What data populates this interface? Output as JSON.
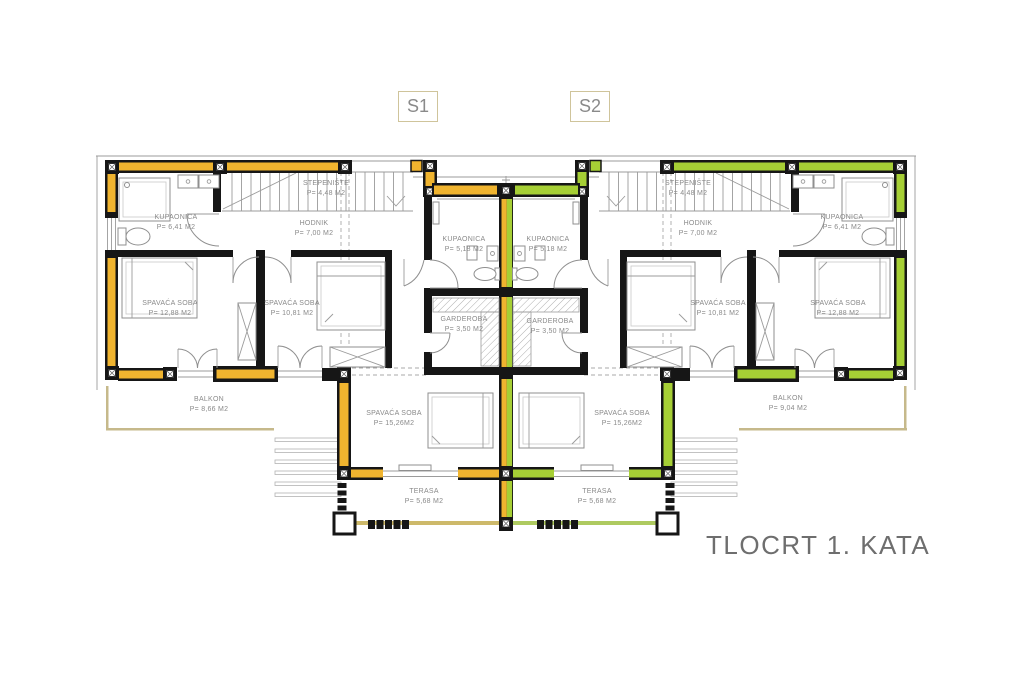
{
  "title": "TLOCRT 1. KATA",
  "section_labels": {
    "s1": "S1",
    "s2": "S2"
  },
  "colors": {
    "s1_wall": "#F0B42F",
    "s2_wall": "#A6CF35",
    "balcony_line": "#C6B98B",
    "terrace_s1_line": "#CDB96A",
    "terrace_s2_line": "#AECA60",
    "box_border": "#CFC49B",
    "label_text": "#8a8a8a",
    "title_text": "#6e6e6e"
  },
  "rooms": {
    "s1": {
      "stepeniste": {
        "name": "STEPENIŠTE",
        "area": "P= 4,48 M2"
      },
      "kupaonica": {
        "name": "KUPAONICA",
        "area": "P= 6,41 M2"
      },
      "hodnik": {
        "name": "HODNIK",
        "area": "P= 7,00 M2"
      },
      "spavaca_velika": {
        "name": "SPAVAĆA SOBA",
        "area": "P= 12,88 M2"
      },
      "spavaca_srednja": {
        "name": "SPAVAĆA SOBA",
        "area": "P= 10,81 M2"
      },
      "kupaonica_mala": {
        "name": "KUPAONICA",
        "area": "P= 5,18 M2"
      },
      "garderoba": {
        "name": "GARDEROBA",
        "area": "P= 3,50 M2"
      },
      "spavaca_donja": {
        "name": "SPAVAĆA SOBA",
        "area": "P= 15,26M2"
      },
      "balkon": {
        "name": "BALKON",
        "area": "P= 8,66 M2"
      },
      "terasa": {
        "name": "TERASA",
        "area": "P= 5,68 M2"
      }
    },
    "s2": {
      "stepeniste": {
        "name": "STEPENIŠTE",
        "area": "P= 4,48 M2"
      },
      "kupaonica": {
        "name": "KUPAONICA",
        "area": "P= 6,41 M2"
      },
      "hodnik": {
        "name": "HODNIK",
        "area": "P= 7,00 M2"
      },
      "spavaca_velika": {
        "name": "SPAVAĆA SOBA",
        "area": "P= 12,88 M2"
      },
      "spavaca_srednja": {
        "name": "SPAVAĆA SOBA",
        "area": "P= 10,81 M2"
      },
      "kupaonica_mala": {
        "name": "KUPAONICA",
        "area": "P= 5,18 M2"
      },
      "garderoba": {
        "name": "GARDEROBA",
        "area": "P= 3,50 M2"
      },
      "spavaca_donja": {
        "name": "SPAVAĆA SOBA",
        "area": "P= 15,26M2"
      },
      "balkon": {
        "name": "BALKON",
        "area": "P= 9,04 M2"
      },
      "terasa": {
        "name": "TERASA",
        "area": "P= 5,68 M2"
      }
    }
  }
}
